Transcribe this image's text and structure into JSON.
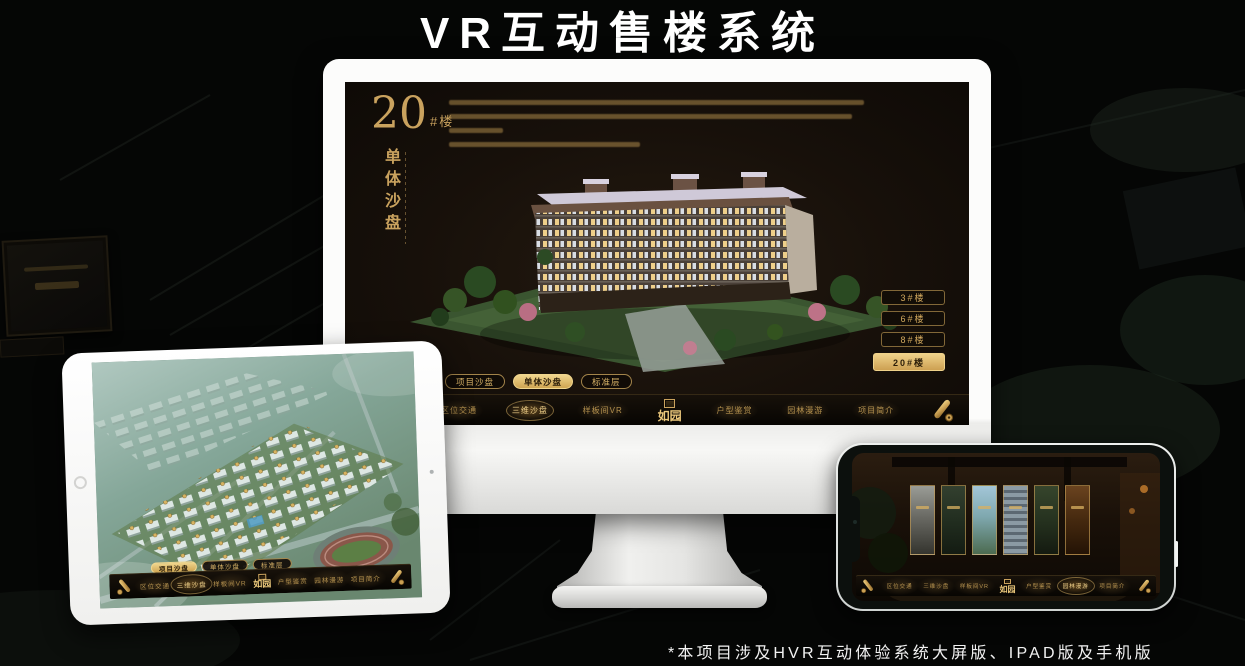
{
  "title": "VR互动售楼系统",
  "footnote": "*本项目涉及HVR互动体验系统大屏版、IPAD版及手机版",
  "brand": {
    "logo": "如园"
  },
  "colors": {
    "gold": "#d2a95e",
    "gold_bright": "#f0d68e",
    "screen_bg": "#17110b"
  },
  "monitor": {
    "headline": {
      "number": "20",
      "suffix": "#楼",
      "vertical": "单体沙盘"
    },
    "floor_buttons": [
      {
        "label": "3#楼",
        "active": false
      },
      {
        "label": "6#楼",
        "active": false
      },
      {
        "label": "8#楼",
        "active": false
      },
      {
        "label": "20#楼",
        "active": true
      }
    ],
    "sub_tabs": [
      {
        "label": "项目沙盘",
        "active": false
      },
      {
        "label": "单体沙盘",
        "active": true
      },
      {
        "label": "标准层",
        "active": false
      }
    ],
    "menu_left": [
      {
        "label": "区位交通",
        "active": false
      },
      {
        "label": "三维沙盘",
        "active": true
      },
      {
        "label": "样板间VR",
        "active": false
      }
    ],
    "menu_right": [
      {
        "label": "户型鉴赏",
        "active": false
      },
      {
        "label": "园林漫游",
        "active": false
      },
      {
        "label": "项目简介",
        "active": false
      }
    ]
  },
  "tablet": {
    "sub_tabs": [
      {
        "label": "项目沙盘",
        "active": true
      },
      {
        "label": "单体沙盘",
        "active": false
      },
      {
        "label": "标准层",
        "active": false
      }
    ],
    "menu_left": [
      {
        "label": "区位交通",
        "active": false
      },
      {
        "label": "三维沙盘",
        "active": true
      },
      {
        "label": "样板间VR",
        "active": false
      }
    ],
    "menu_right": [
      {
        "label": "户型鉴赏",
        "active": false
      },
      {
        "label": "园林漫游",
        "active": false
      },
      {
        "label": "项目简介",
        "active": false
      }
    ]
  },
  "phone": {
    "menu_left": [
      {
        "label": "区位交通",
        "active": false
      },
      {
        "label": "三维沙盘",
        "active": false
      },
      {
        "label": "样板间VR",
        "active": false
      }
    ],
    "menu_right": [
      {
        "label": "户型鉴赏",
        "active": false
      },
      {
        "label": "园林漫游",
        "active": true
      },
      {
        "label": "项目简介",
        "active": false
      }
    ]
  }
}
